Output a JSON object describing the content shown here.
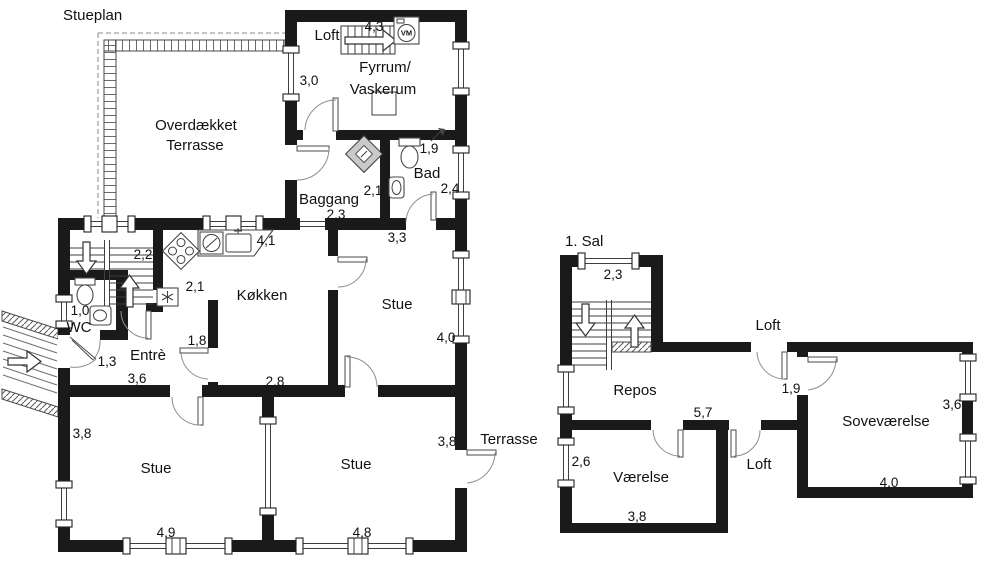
{
  "ground": {
    "title": "Stueplan",
    "rooms": {
      "loft": "Loft",
      "fyrrum_1": "Fyrrum/",
      "fyrrum_2": "Vaskerum",
      "overdaekket_1": "Overdækket",
      "overdaekket_2": "Terrasse",
      "baggang": "Baggang",
      "bad": "Bad",
      "kokken": "Køkken",
      "stue_mid": "Stue",
      "wc": "WC",
      "entre": "Entrè",
      "stue_left": "Stue",
      "stue_bottom": "Stue",
      "terrasse": "Terrasse"
    },
    "dims": {
      "loft_ladder": "4,3",
      "fyrrum_wall": "3,0",
      "bad_width": "1,9",
      "bad_depth": "2,4",
      "baggang_width": "2,1",
      "baggang_depth": "2,3",
      "stue_mid_width": "3,3",
      "stue_mid_depth": "4,0",
      "stair_width": "2,2",
      "kokken_counter": "4,1",
      "kokken_passage": "2,1",
      "kokken_wall": "1,8",
      "wc_width": "1,0",
      "entre_door": "1,3",
      "entre_width": "3,6",
      "kokken_width": "2,8",
      "stue_left_depth": "3,8",
      "stue_left_width": "4,9",
      "stue_bottom_depth": "3,8",
      "stue_bottom_width": "4,8"
    },
    "icons": {
      "washer": "VM"
    }
  },
  "first": {
    "title": "1. Sal",
    "rooms": {
      "loft_north": "Loft",
      "repos": "Repos",
      "sovevaerelse": "Soveværelse",
      "vaerelse": "Værelse",
      "loft_south": "Loft"
    },
    "dims": {
      "stair_width": "2,3",
      "sove_door": "1,9",
      "sove_depth": "3,6",
      "sove_width": "4,0",
      "repos_width": "5,7",
      "vaerelse_depth": "2,6",
      "vaerelse_width": "3,8"
    }
  },
  "colors": {
    "walls": "#1a1a1a",
    "text": "#111111",
    "thin_lines": "#3f3f3f",
    "background": "#ffffff"
  }
}
